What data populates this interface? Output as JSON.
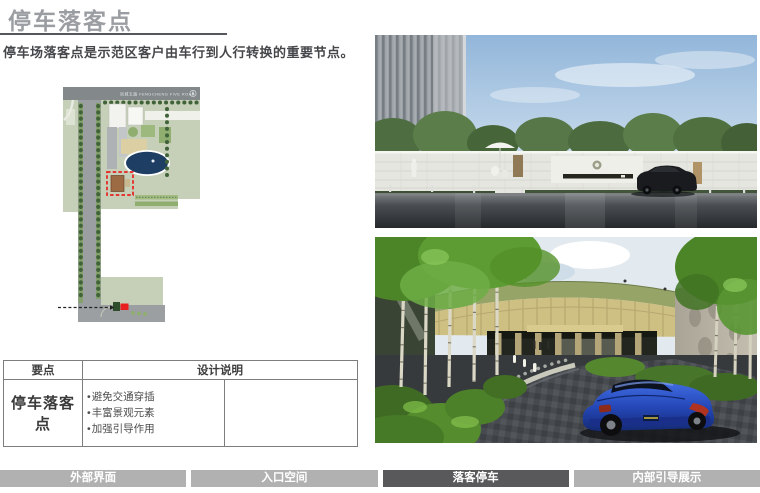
{
  "header": {
    "title": "停车落客点",
    "subtitle": "停车场落客点是示范区客户由车行到人行转换的重要节点。"
  },
  "site_plan": {
    "road_label": "凤城五路  FENGCHENG FIVE ROAD",
    "north_icon": "north-arrow",
    "highlight_color": "#e8201f"
  },
  "table": {
    "headers": {
      "point": "要点",
      "description": "设计说明"
    },
    "rows": [
      {
        "point": "停车落客点",
        "notes": [
          "避免交通穿插",
          "丰富景观元素",
          "加强引导作用"
        ]
      }
    ]
  },
  "tabs": {
    "items": [
      {
        "label": "外部界面",
        "active": false
      },
      {
        "label": "入口空间",
        "active": false
      },
      {
        "label": "落客停车",
        "active": true
      },
      {
        "label": "内部引导展示",
        "active": false
      }
    ]
  },
  "colors": {
    "accent_red": "#e8201f",
    "tab_active": "#59595b",
    "tab_inactive": "#b1b1b1",
    "title_gray": "#9a9da1"
  }
}
